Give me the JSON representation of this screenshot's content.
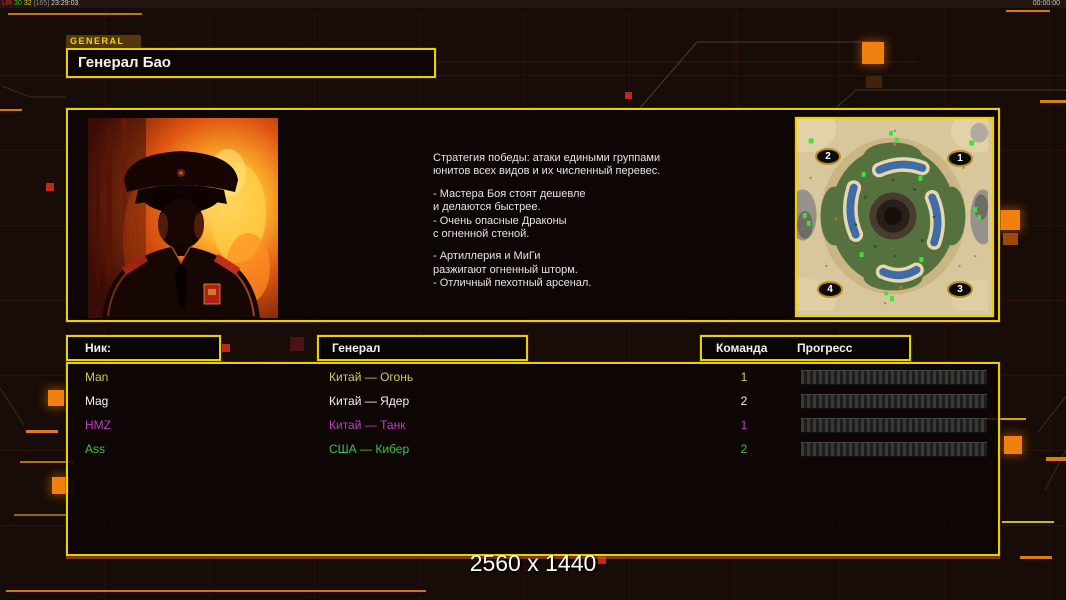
{
  "overlay": {
    "stats_left": {
      "tag": "UR",
      "num1": "30",
      "num2": "32",
      "bracket": "[165]",
      "clock": "23:29:03"
    },
    "clock_right": "00:00:00"
  },
  "header": {
    "tab": "GENERAL",
    "title": "Генерал Бао"
  },
  "briefing": {
    "lines": [
      "Стратегия победы: атаки едиными группами",
      "юнитов всех видов и их численный перевес.",
      "",
      "- Мастера Боя стоят дешевле",
      "и делаются быстрее.",
      "- Очень опасные Драконы",
      "с огненной стеной.",
      "",
      "- Артиллерия и МиГи",
      "разжигают огненный шторм.",
      "- Отличный пехотный арсенал."
    ]
  },
  "map_preview": {
    "markers": {
      "top_left": "2",
      "top_right": "1",
      "bottom_left": "4",
      "bottom_right": "3"
    }
  },
  "players": {
    "headers": {
      "nick": "Ник:",
      "general": "Генерал",
      "team": "Команда",
      "progress": "Прогресс"
    },
    "rows": [
      {
        "nick": "Man",
        "general": "Китай — Огонь",
        "team": "1",
        "color": "#cfcf45",
        "progress_percent": 0
      },
      {
        "nick": "Mag",
        "general": "Китай — Ядер",
        "team": "2",
        "color": "#f2f2f2",
        "progress_percent": 0
      },
      {
        "nick": "HMZ",
        "general": "Китай — Танк",
        "team": "1",
        "color": "#bf3fbf",
        "progress_percent": 0
      },
      {
        "nick": "Ass",
        "general": "США — Кибер",
        "team": "2",
        "color": "#3fc43f",
        "progress_percent": 0
      }
    ]
  },
  "footer": {
    "resolution_label": "2560 x 1440"
  },
  "colors": {
    "panel_border": "#e6d200",
    "accent_orange": "#f08010",
    "status_red": "#c22818",
    "page_bg": "#170c07",
    "player_yellow": "#cfcf45",
    "player_white": "#f2f2f2",
    "player_magenta": "#bf3fbf",
    "player_green": "#3fc43f"
  }
}
